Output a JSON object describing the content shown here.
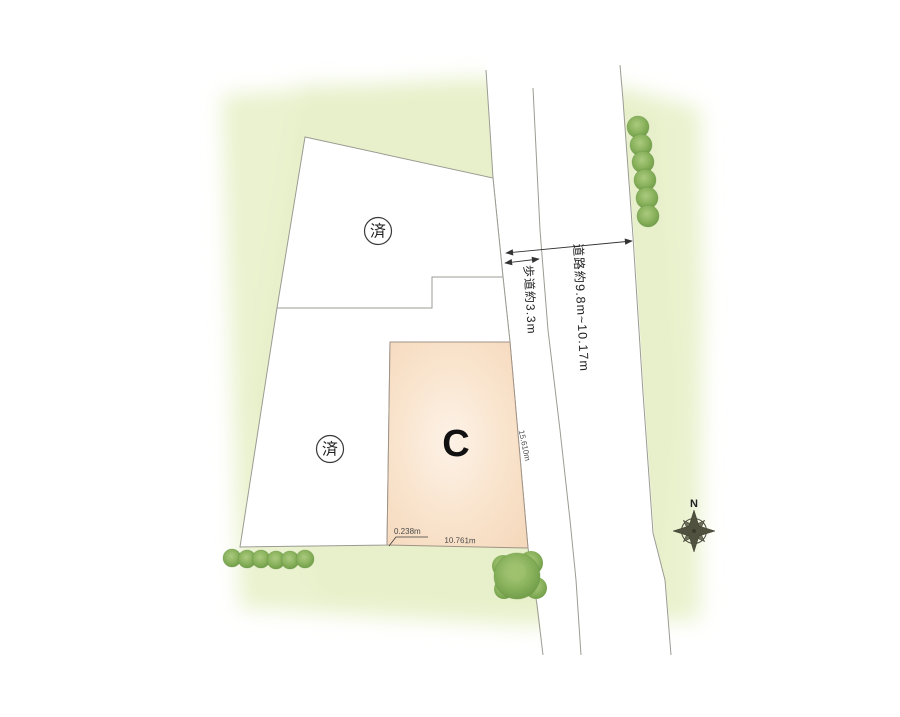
{
  "plan": {
    "lots": [
      {
        "id": "lot-a",
        "status": "済"
      },
      {
        "id": "lot-b",
        "status": "済"
      },
      {
        "id": "lot-c",
        "label": "C"
      }
    ],
    "dimensions": {
      "sidewalk": "歩道約3.3m",
      "road": "道路約9.8m~10.17m",
      "lot_c_right": "15.610m",
      "lot_c_bottom": "10.761m",
      "lot_c_offset": "0.238m"
    },
    "compass": {
      "north": "N"
    },
    "colors": {
      "greenery": "#eaf2cf",
      "lot_fill": "#ffffff",
      "lot_c_fill": "#f8e0c8",
      "tree": "#8bb35e",
      "boundary": "#9b9b93",
      "dimension_text": "#222222"
    }
  }
}
